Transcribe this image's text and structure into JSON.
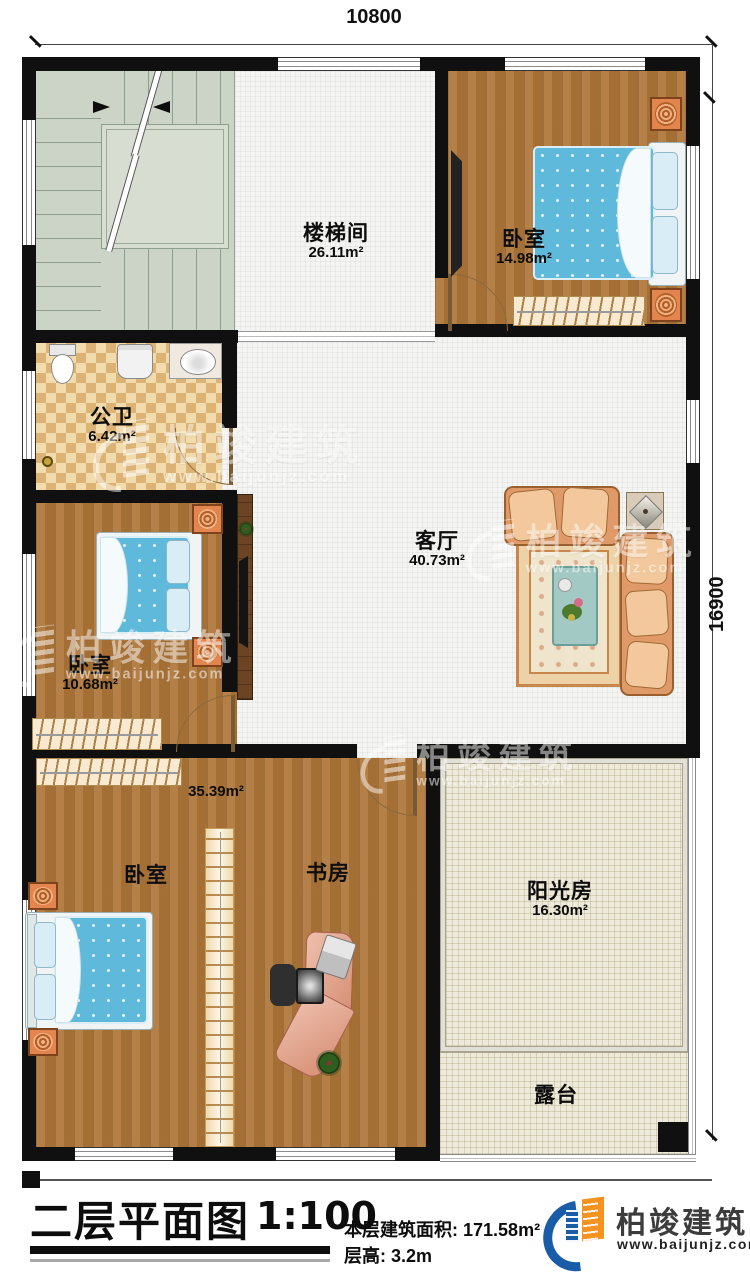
{
  "dimensions": {
    "top": "10800",
    "right": "16900"
  },
  "rooms": {
    "stairwell": {
      "name": "楼梯间",
      "area": "26.11m²"
    },
    "bedroom_top": {
      "name": "卧室",
      "area": "14.98m²"
    },
    "bathroom": {
      "name": "公卫",
      "area": "6.42m²"
    },
    "living": {
      "name": "客厅",
      "area": "40.73m²"
    },
    "bedroom_left": {
      "name": "卧室",
      "area": "10.68m²"
    },
    "bottom_combined_area": "35.39m²",
    "bedroom_bottom": {
      "name": "卧室"
    },
    "study": {
      "name": "书房"
    },
    "sunroom": {
      "name": "阳光房",
      "area": "16.30m²"
    },
    "terrace": {
      "name": "露台"
    }
  },
  "title_block": {
    "title": "二层平面图",
    "scale": "1:100",
    "floor_area_label": "本层建筑面积:",
    "floor_area_value": "171.58m²",
    "floor_height_label": "层高:",
    "floor_height_value": "3.2m"
  },
  "brand": {
    "name": "柏竣建筑",
    "url": "www.baijunjz.com",
    "blue": "#1b5ca9",
    "orange": "#f69220"
  },
  "watermark": {
    "name": "柏竣建筑",
    "url": "www.baijunjz.com"
  }
}
